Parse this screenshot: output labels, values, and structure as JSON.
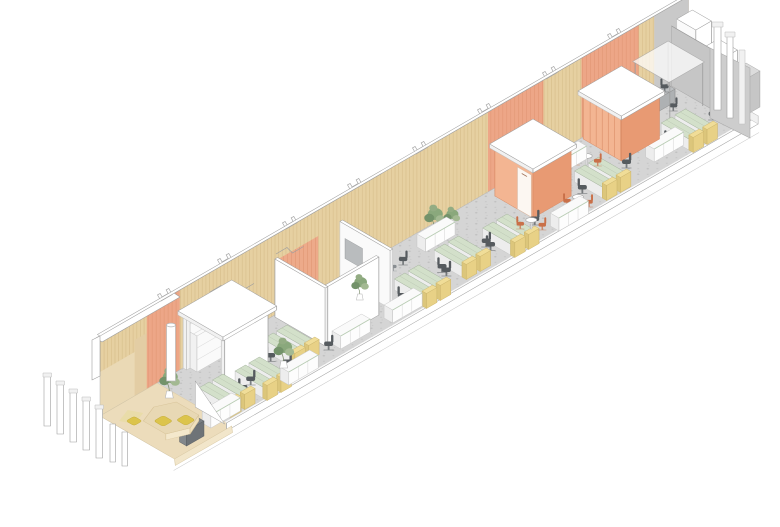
{
  "meta": {
    "title": "Axonometric illustration of a long narrow office interior",
    "style": "architectural line-and-color axonometric drawing on white background",
    "canvas": {
      "width": 780,
      "height": 527
    }
  },
  "palette": {
    "background": "#ffffff",
    "outline": "#9e9e9e",
    "floor": "#d5d5d5",
    "floor_dot": "#b0b0b0",
    "wood": "#e6d0a1",
    "wood_line": "#cbae79",
    "orange": "#eda687",
    "orange_line": "#d88a64",
    "pod_front": "#e89a73",
    "pod_side": "#f3b592",
    "desk_top": "#d3e0ca",
    "screen_yellow": "#e8d186",
    "chair_dark": "#565b5f",
    "chair_orange": "#c97049",
    "plant": "#8aa87c",
    "plant_dark": "#73926a",
    "lounge_floor": "#ecdcbb",
    "pouf": "#dcc44c",
    "gray_wall": "#c6c6c6",
    "screen_gray": "#b9bcbe"
  },
  "scene": {
    "view": "isometric, strip runs lower-left to upper-right",
    "zones": [
      {
        "name": "lounge",
        "features": [
          "timber platform floor",
          "hexagonal seating platform",
          "yellow poufs",
          "radiator",
          "glazed end facade with white mullions"
        ]
      },
      {
        "name": "open-office-1",
        "features": [
          "desk clusters with green tops and yellow end screens",
          "black task chairs",
          "white storage credenzas",
          "white canopy frame with shelving",
          "potted plants",
          "white column"
        ]
      },
      {
        "name": "meeting-room",
        "features": [
          "white cut-away walls",
          "orange curtain on back wall",
          "white conference table",
          "orange and green chairs",
          "grey wall screen",
          "credenza"
        ]
      },
      {
        "name": "open-office-2",
        "features": [
          "desk clusters",
          "cafe tables",
          "round tables with terracotta chairs",
          "plants",
          "credenzas"
        ]
      },
      {
        "name": "pod-1",
        "features": [
          "orange meeting pod with white flat roof and white door"
        ]
      },
      {
        "name": "open-office-3",
        "features": [
          "desk cluster",
          "credenza",
          "round table with terracotta chairs"
        ]
      },
      {
        "name": "pod-2",
        "features": [
          "orange slatted meeting pod with white roof"
        ]
      },
      {
        "name": "end-zone",
        "features": [
          "outlined glass canopy room with dark table",
          "grey core wall",
          "white service volumes",
          "desk cluster"
        ]
      }
    ],
    "architecture": {
      "back_wall": "full-height vertical timber slats with orange panel sections and grey end section",
      "above_wall": "outline-only roof profiles, notched purlin sections and sloped beam",
      "floor": "speckled grey screed with white slab edge and skirt"
    }
  }
}
